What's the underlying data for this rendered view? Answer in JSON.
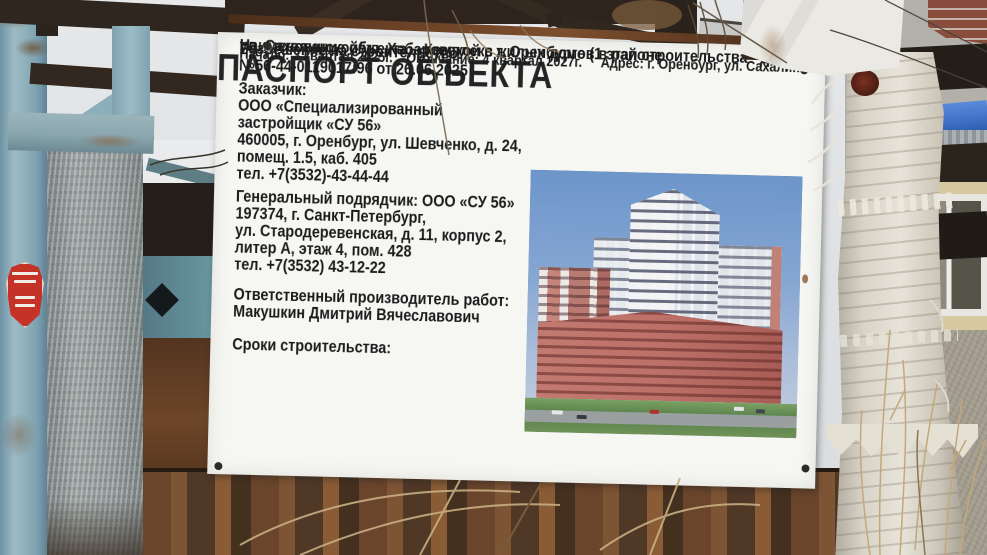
{
  "sign": {
    "title": "ПАСПОРТ ОБЪЕКТА",
    "object_name": [
      "Наименование объекта: «Комплекс жилых домов в районе",
      "ул. Сахалинской/ул. Хабаровской в г. Оренбурге (1 этап строительства - дом №1)»"
    ],
    "permit": {
      "label": "Разрешение на строительство:",
      "value": "№56-44-0119017:96 от 26.06.2025"
    },
    "customer": {
      "label": "Заказчик:",
      "lines": [
        "ООО «Специализированный",
        "застройщик «СУ 56»",
        "460005, г. Оренбург, ул. Шевченко, д. 24,",
        "помещ. 1.5, каб. 405",
        "тел. +7(3532)-43-44-44"
      ]
    },
    "contractor": {
      "lines": [
        "Генеральный подрядчик: ООО «СУ 56»",
        "197374, г. Санкт-Петербург,",
        "ул. Стародеревенская, д. 11, корпус 2,",
        "литер А, этаж 4, пом. 428",
        "тел. +7(3532) 43-12-22"
      ]
    },
    "responsible": {
      "label": "Ответственный производитель работ:",
      "value": "Макушкин Дмитрий Вячеславович"
    },
    "terms": {
      "label": "Сроки строительства:",
      "start": "Начало: 3 квартал 2025г.",
      "end": "Окончание: 4 квартал 2027г.",
      "address": "Адрес: г. Оренбург, ул. Сахалинская"
    }
  },
  "colors": {
    "sign_background": "#f6f6f3",
    "sign_text": "#1b1b1c",
    "frame_rust": "#6b4226",
    "post_blue": "#8fb0ba",
    "sticker_red": "#c53227",
    "tarp_blue": "#3f72c8",
    "render_sky": "#6d95ca",
    "render_facade_pink": "#bd7168",
    "render_lawn": "#5e8a50",
    "trunk_white": "#d9d4c8"
  }
}
